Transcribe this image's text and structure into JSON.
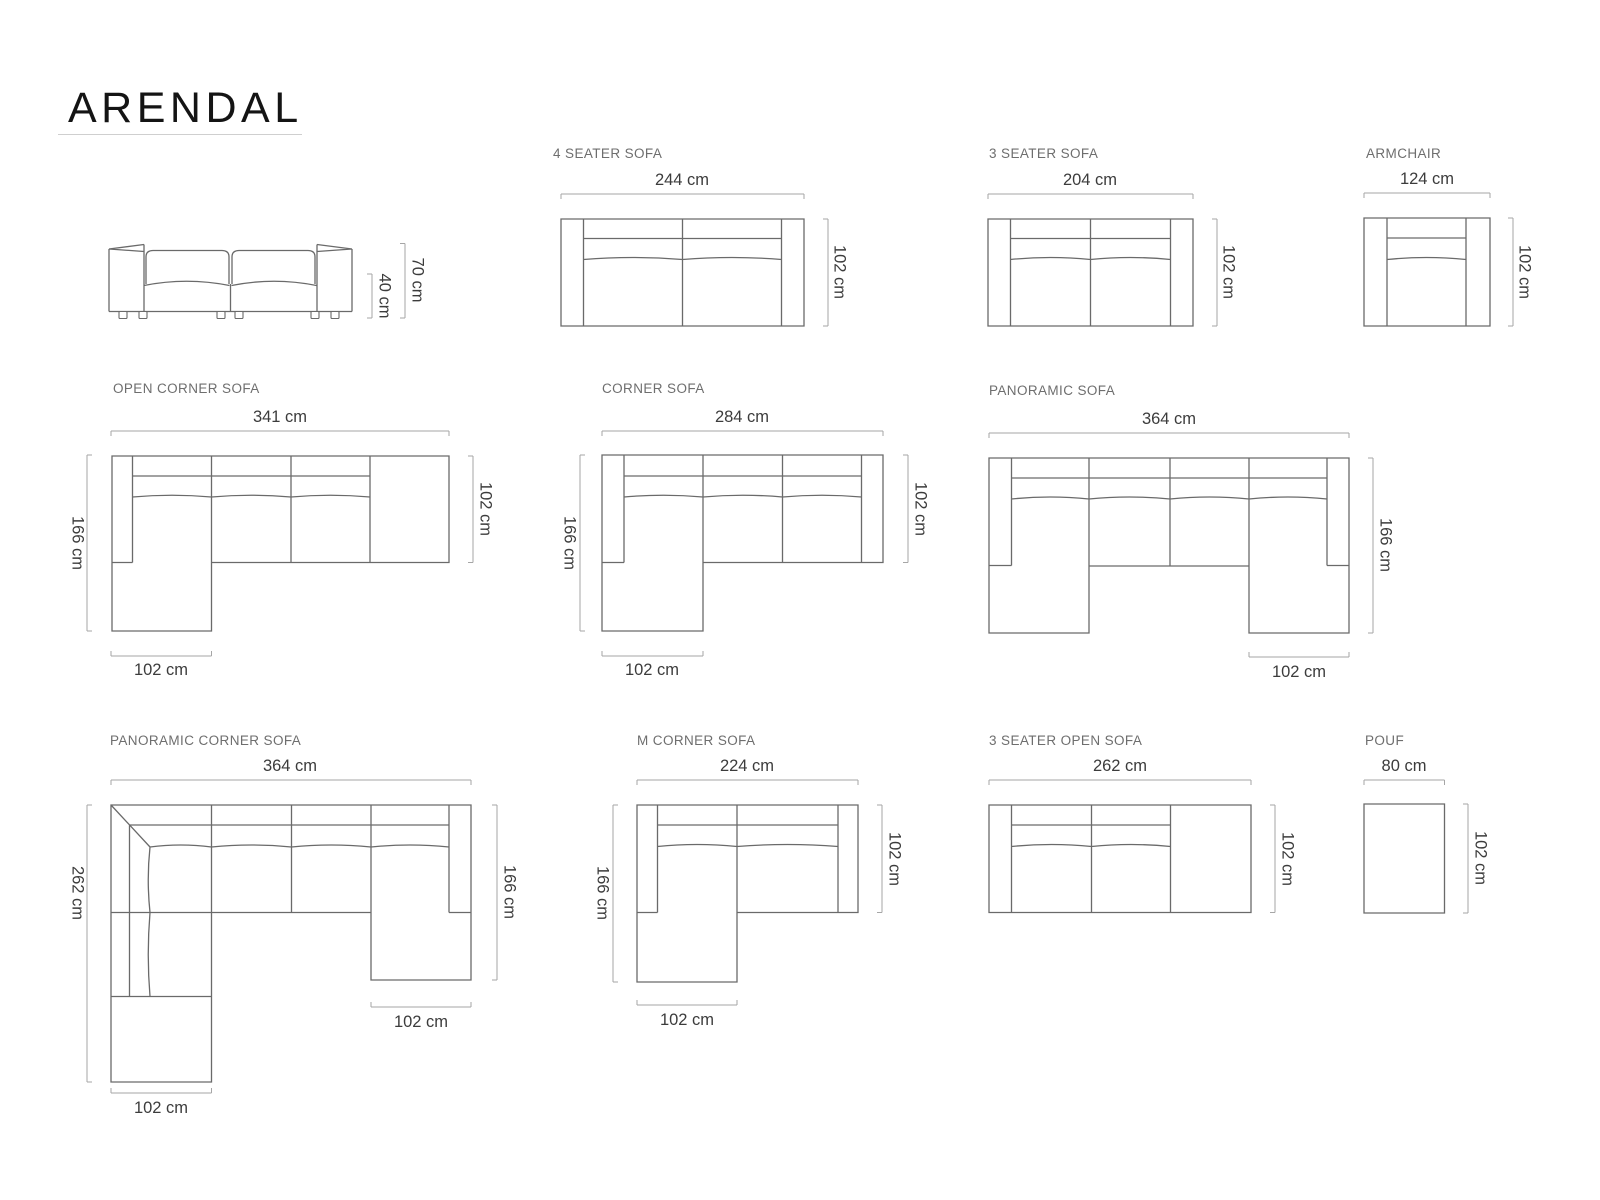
{
  "title": "ARENDAL",
  "diagrams": {
    "front_view": {
      "height_total": "70 cm",
      "height_seat": "40 cm"
    },
    "four_seater": {
      "label": "4 SEATER SOFA",
      "width": "244 cm",
      "depth": "102 cm"
    },
    "three_seater": {
      "label": "3 SEATER SOFA",
      "width": "204 cm",
      "depth": "102 cm"
    },
    "armchair": {
      "label": "ARMCHAIR",
      "width": "124 cm",
      "depth": "102 cm"
    },
    "open_corner": {
      "label": "OPEN CORNER SOFA",
      "width": "341 cm",
      "height": "166 cm",
      "depth": "102 cm",
      "chaise": "102 cm"
    },
    "corner": {
      "label": "CORNER SOFA",
      "width": "284 cm",
      "height": "166 cm",
      "depth": "102 cm",
      "chaise": "102 cm"
    },
    "panoramic": {
      "label": "PANORAMIC SOFA",
      "width": "364 cm",
      "height": "166 cm",
      "chaise": "102 cm"
    },
    "panoramic_corner": {
      "label": "PANORAMIC CORNER SOFA",
      "width": "364 cm",
      "height_left": "262 cm",
      "height_right": "166 cm",
      "chaise_right": "102 cm",
      "chaise_bottom": "102 cm"
    },
    "m_corner": {
      "label": "M CORNER SOFA",
      "width": "224 cm",
      "height": "166 cm",
      "depth": "102 cm",
      "chaise": "102 cm"
    },
    "three_seater_open": {
      "label": "3 SEATER OPEN SOFA",
      "width": "262 cm",
      "depth": "102 cm"
    },
    "pouf": {
      "label": "POUF",
      "width": "80 cm",
      "depth": "102 cm"
    }
  }
}
